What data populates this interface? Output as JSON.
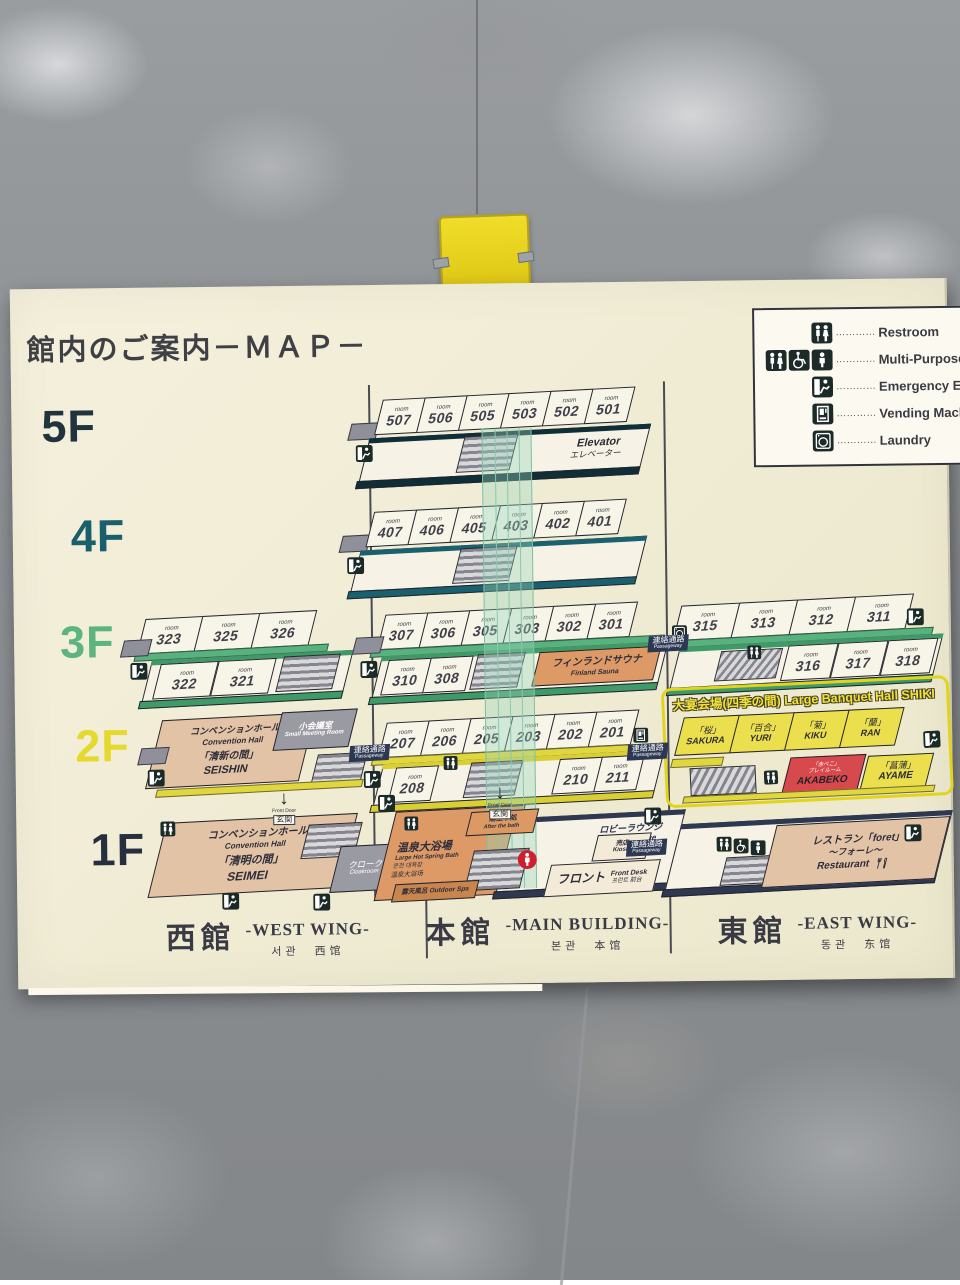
{
  "board": {
    "title": "館内のご案内－ＭＡＰ－",
    "room_label": "room",
    "legend": {
      "dots": "…………",
      "items": [
        {
          "label": "Restroom"
        },
        {
          "label": "Multi-Purpose Re"
        },
        {
          "label": "Emergency Exit"
        },
        {
          "label": "Vending Machine"
        },
        {
          "label": "Laundry"
        }
      ]
    },
    "floor_labels": [
      "5F",
      "4F",
      "3F",
      "2F",
      "1F"
    ],
    "f5": {
      "rooms": [
        "507",
        "506",
        "505",
        "503",
        "502",
        "501"
      ],
      "elevator_en": "Elevator",
      "elevator_jp": "エレベーター"
    },
    "f4": {
      "rooms": [
        "407",
        "406",
        "405",
        "403",
        "402",
        "401"
      ]
    },
    "f3": {
      "west_top": [
        "323",
        "325",
        "326"
      ],
      "west_bottom": [
        "322",
        "321"
      ],
      "main_top": [
        "307",
        "306",
        "305",
        "303",
        "302",
        "301"
      ],
      "main_bottom": [
        "310",
        "308"
      ],
      "sauna_jp": "フィンランドサウナ",
      "sauna_en": "Finland Sauna",
      "east_top": [
        "315",
        "313",
        "312",
        "311"
      ],
      "east_bottom": [
        "316",
        "317",
        "318"
      ]
    },
    "f2": {
      "hall_jp": "コンベンションホール",
      "hall_en": "Convention Hall",
      "hall_name_jp": "「清新の間」",
      "hall_name_en": "SEISHIN",
      "meeting_jp": "小会議室",
      "meeting_en": "Small Meeting Room",
      "main_top": [
        "207",
        "206",
        "205",
        "203",
        "202",
        "201"
      ],
      "room_208": "208",
      "room_210": "210",
      "room_211": "211",
      "banquet_jp": "大宴会場(四季の間)",
      "banquet_en": "Large Banquet Hall SHIKI",
      "banquet_rooms": [
        {
          "jp": "「桜」",
          "en": "SAKURA"
        },
        {
          "jp": "「百合」",
          "en": "YURI"
        },
        {
          "jp": "「菊」",
          "en": "KIKU"
        },
        {
          "jp": "「蘭」",
          "en": "RAN"
        }
      ],
      "akabeko_jp": "「赤べこ」",
      "akabeko_jp2": "プレイルーム",
      "akabeko_en": "AKABEKO",
      "ayame_jp": "「菖蒲」",
      "ayame_en": "AYAME"
    },
    "f1": {
      "hall_jp": "コンベンションホール",
      "hall_en": "Convention Hall",
      "hall_name_jp": "「清明の間」",
      "hall_name_en": "SEIMEI",
      "cloak_jp": "クローク",
      "cloak_en": "Cloakroom",
      "door_en": "Front Door",
      "door_jp": "玄関",
      "afterbath_jp": "湯上り処",
      "afterbath_en": "After the bath",
      "bath_jp": "温泉大浴場",
      "bath_en": "Large Hot Spring Bath",
      "bath_kr": "온천 대욕장",
      "bath_cn": "温泉大浴场",
      "outdoor_jp": "露天風呂",
      "outdoor_en": "Outdoor Spa",
      "lobby_jp": "ロビーラウンジ",
      "lobby_en": "Lobby Lounge",
      "front_jp": "フロント",
      "front_en": "Front Desk",
      "front_sub": "프런트  前台",
      "kiosk_jp": "売店",
      "kiosk_en": "Kiosk",
      "restaurant_jp": "レストラン「foret」",
      "restaurant_jp2": "～フォーレ～",
      "restaurant_en": "Restaurant"
    },
    "passage_jp": "連絡通路",
    "passage_en": "Passageway",
    "wings": [
      {
        "jp": "西館",
        "en": "-WEST WING-",
        "sub": "서관　西馆"
      },
      {
        "jp": "本館",
        "en": "-MAIN BUILDING-",
        "sub": "본관　本馆"
      },
      {
        "jp": "東館",
        "en": "-EAST WING-",
        "sub": "동관　东馆"
      }
    ]
  }
}
